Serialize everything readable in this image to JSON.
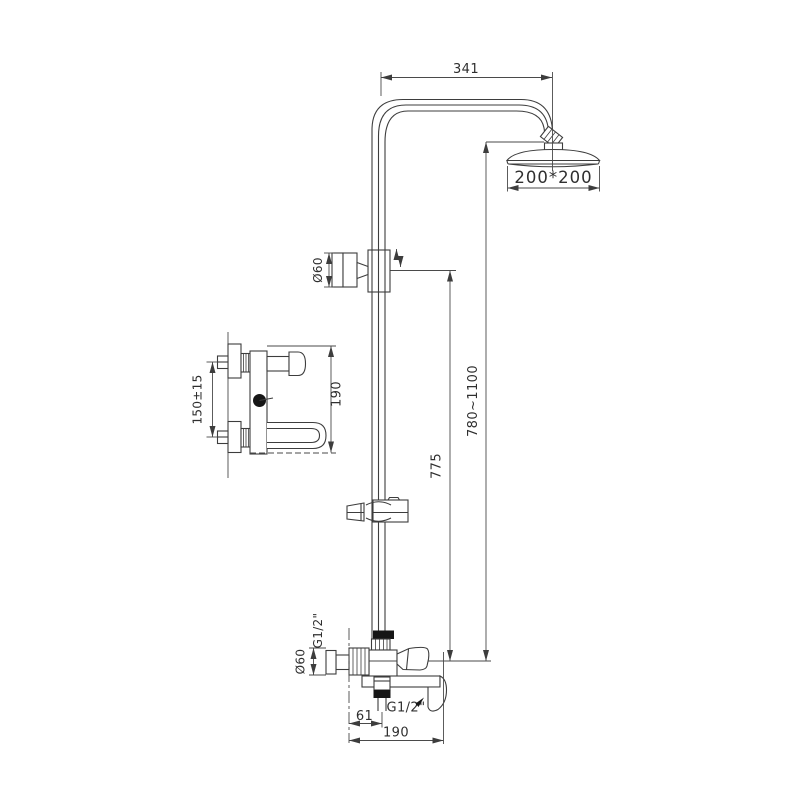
{
  "drawing": {
    "kind": "shower-column-technical-drawing",
    "colors": {
      "line": "#3d3d3d",
      "background": "#ffffff",
      "solid_black": "#161616"
    }
  },
  "labels": {
    "arm_reach": "341",
    "head_size": "200*200",
    "upper_knob_diameter": "Ø60",
    "slide_height_range": "780~1100",
    "riser_height": "775",
    "upper_thread": "G1/2\"",
    "lower_knob_diameter": "Ø60",
    "outlet_thread": "G1/2\"",
    "outlet_offset": "61",
    "spout_reach": "190",
    "detail_inlet_spacing": "150±15",
    "detail_height": "190"
  }
}
